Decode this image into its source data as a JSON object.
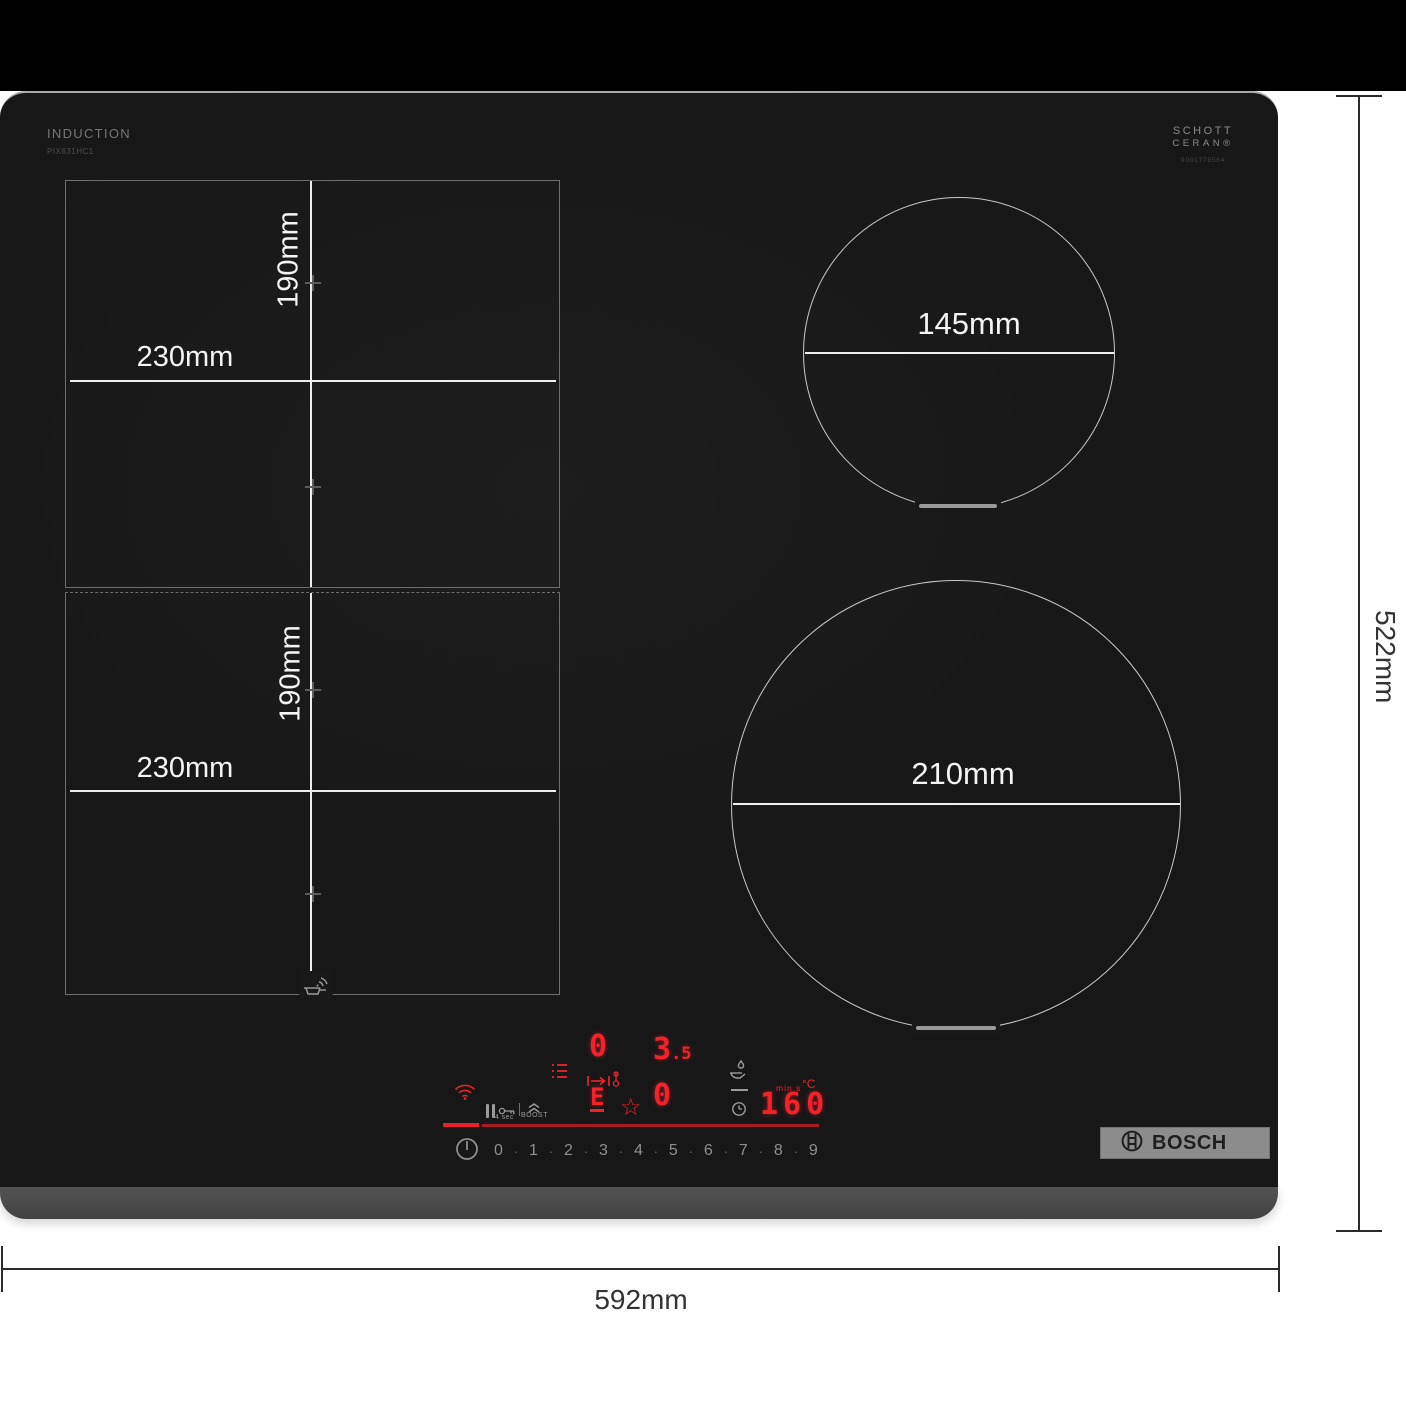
{
  "branding": {
    "induction_label": "INDUCTION",
    "model_number": "PIX631HC1",
    "glass_brand_line1": "SCHOTT",
    "glass_brand_line2": "CERAN®",
    "glass_brand_serial": "9001778564",
    "bosch_wordmark": "BOSCH"
  },
  "zones": {
    "flex_top": {
      "depth_label": "190mm",
      "width_label": "230mm"
    },
    "flex_bottom": {
      "depth_label": "190mm",
      "width_label": "230mm"
    },
    "circle_small": {
      "diameter_label": "145mm"
    },
    "circle_large": {
      "diameter_label": "210mm"
    }
  },
  "outer_dimensions": {
    "width_label": "592mm",
    "depth_label": "522mm"
  },
  "control_panel": {
    "zone_display_left": "0",
    "power_display_main": "3",
    "power_display_sub": ".5",
    "zone_display_mid": "0",
    "flex_segment_letter": "E",
    "timer_display": "160",
    "timer_unit_label": "min s",
    "temperature_unit_label": "°C",
    "key_hold_label": "4 sec",
    "boost_label": "BOOST",
    "power_scale": [
      "0",
      "1",
      "2",
      "3",
      "4",
      "5",
      "6",
      "7",
      "8",
      "9"
    ],
    "power_scale_separator": "·"
  },
  "icons": {
    "star": "☆"
  },
  "colors": {
    "accent_red": "#e8212a",
    "display_red": "#f3222a",
    "line_red_dim": "#a81d22",
    "hob_surface": "#191919"
  }
}
